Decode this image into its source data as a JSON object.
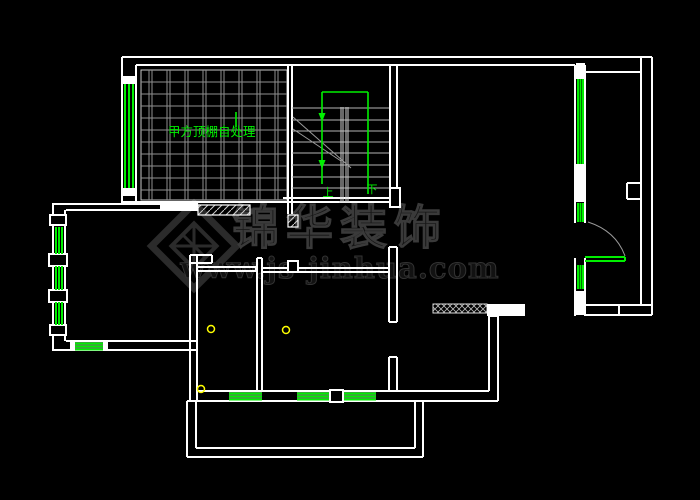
{
  "drawing": {
    "type": "cad-floor-plan",
    "background_color": "#000000",
    "wall_color": "#ffffff",
    "grid_color": "#8f8f8f",
    "window_color": "#00ef00",
    "fixture_color": "#ffff00",
    "watermark_color": "#2b2b2b",
    "annotations": {
      "skylight_note": "甲方顶棚自处理",
      "stair_up": "上",
      "stair_down": "下"
    },
    "watermark": {
      "brand": "锦华装饰",
      "url": "www.js-jinhua.com"
    }
  }
}
